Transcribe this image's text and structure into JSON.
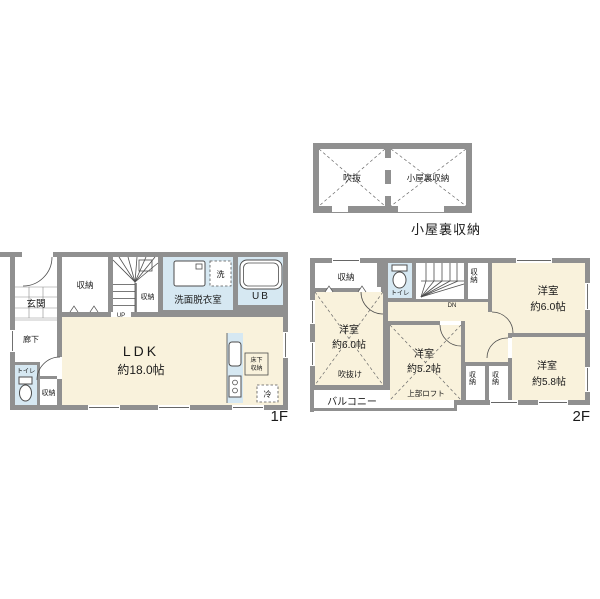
{
  "page": {
    "background": "#ffffff"
  },
  "colors": {
    "wall": "#909090",
    "room": "#F9F2DC",
    "wet": "#D6E8F2",
    "text": "#1a1a1a"
  },
  "attic": {
    "title": "小屋裏収納",
    "void_label": "吹抜",
    "storage_label": "小屋裏収納"
  },
  "floor1": {
    "floor_label": "1F",
    "entrance": "玄関",
    "closet_top": "収納",
    "closet_stairs": "収納",
    "stairs_up": "UP",
    "washroom": "洗面脱衣室",
    "laundry": "洗",
    "unit_bath": "UB",
    "hallway": "廊下",
    "toilet": "トイレ",
    "closet_hall": "収納",
    "ldk_name": "LDK",
    "ldk_size": "約18.0帖",
    "underfloor_storage_line1": "床下",
    "underfloor_storage_line2": "収納",
    "refrigerator": "冷"
  },
  "floor2": {
    "floor_label": "2F",
    "closet_nw": "収納",
    "toilet": "トイレ",
    "stairs_dn": "DN",
    "closet_stairs": "収納",
    "room_west_name": "洋室",
    "room_west_size": "約6.0帖",
    "room_west_note": "吹抜け",
    "room_ne_name": "洋室",
    "room_ne_size": "約6.0帖",
    "room_mid_name": "洋室",
    "room_mid_size": "約5.2帖",
    "room_mid_note": "上部ロフト",
    "closet_s1": "収納",
    "closet_s2": "収納",
    "room_se_name": "洋室",
    "room_se_size": "約5.8帖",
    "balcony": "バルコニー"
  }
}
